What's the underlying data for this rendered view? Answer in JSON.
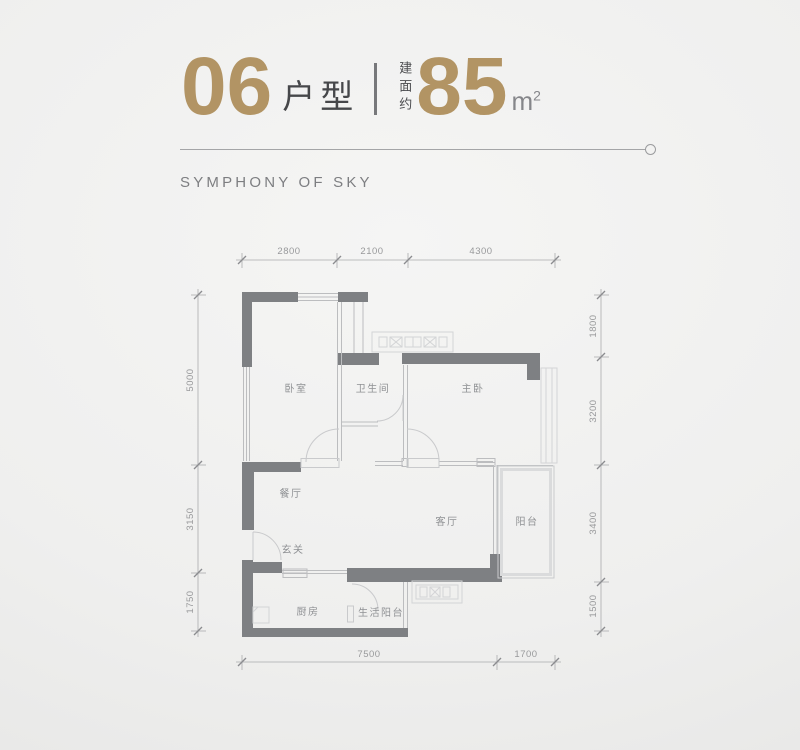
{
  "header": {
    "unit_number": "06",
    "unit_label": "户型",
    "area_prefix": "建面约",
    "area_value": "85",
    "area_unit": "m",
    "area_unit_sup": "2",
    "tagline": "SYMPHONY OF SKY"
  },
  "colors": {
    "accent_gold": "#b29464",
    "wall_gray": "#7e8083",
    "dim_text": "#98999b",
    "background": "#efefee"
  },
  "floorplan": {
    "rooms": [
      {
        "id": "bedroom",
        "label": "卧室"
      },
      {
        "id": "bathroom",
        "label": "卫生间"
      },
      {
        "id": "master-bedroom",
        "label": "主卧"
      },
      {
        "id": "dining-room",
        "label": "餐厅"
      },
      {
        "id": "living-room",
        "label": "客厅"
      },
      {
        "id": "balcony",
        "label": "阳台"
      },
      {
        "id": "entry",
        "label": "玄关"
      },
      {
        "id": "kitchen",
        "label": "厨房"
      },
      {
        "id": "utility-balcony",
        "label": "生活阳台"
      }
    ],
    "dimensions": {
      "top": [
        "2800",
        "2100",
        "4300"
      ],
      "bottom": [
        "7500",
        "1700"
      ],
      "left": [
        "5000",
        "3150",
        "1750"
      ],
      "right": [
        "1800",
        "3200",
        "3400",
        "1500"
      ]
    }
  }
}
